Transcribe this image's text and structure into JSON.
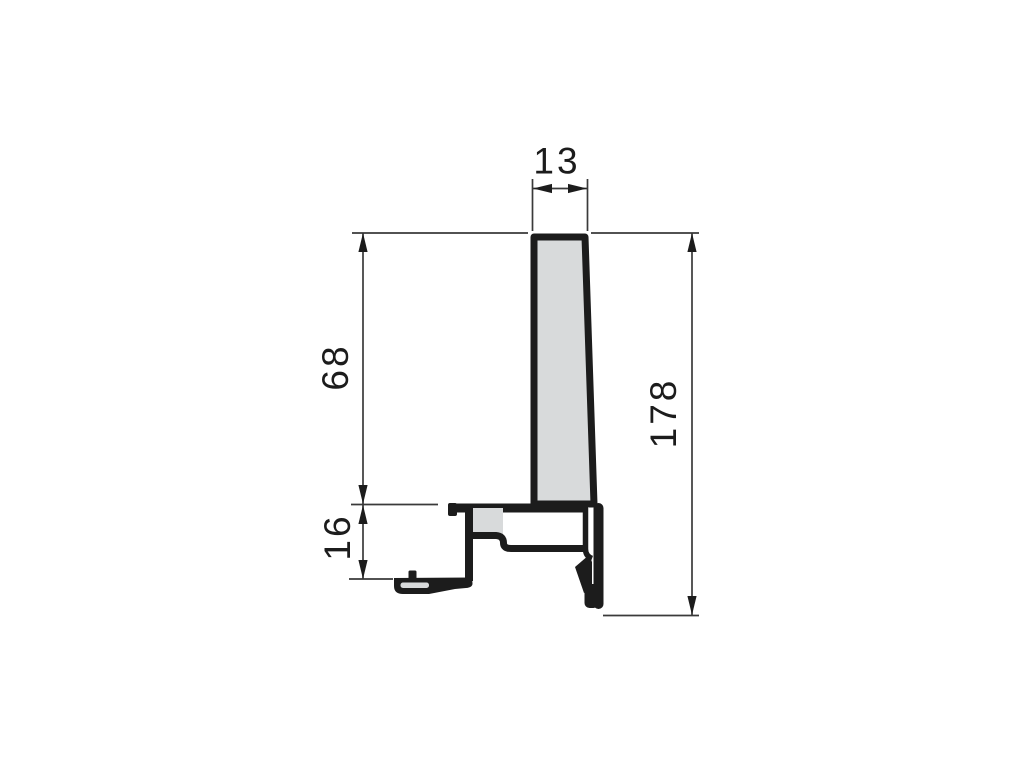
{
  "page": {
    "background": "#ffffff"
  },
  "drawing": {
    "kind": "profile-cross-section-dimension-drawing",
    "dimensions": {
      "top_width": {
        "label": "13",
        "orientation": "horizontal"
      },
      "upper_height": {
        "label": "68",
        "orientation": "vertical"
      },
      "lower_height": {
        "label": "16",
        "orientation": "vertical"
      },
      "total_height": {
        "label": "178",
        "orientation": "vertical"
      }
    },
    "colors": {
      "outline": "#1c1c1c",
      "fill": "#d8dadb",
      "dimline": "#3a3a3a",
      "text": "#1c1c1c",
      "background": "#ffffff"
    }
  }
}
